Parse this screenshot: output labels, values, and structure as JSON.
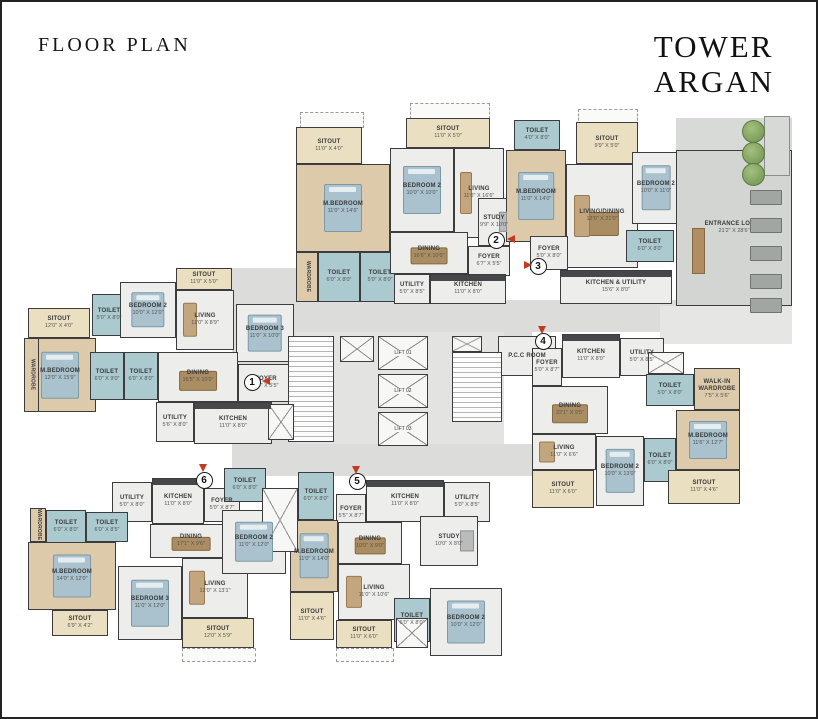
{
  "header": {
    "title": "FLOOR PLAN",
    "tower_line1": "TOWER",
    "tower_line2": "ARGAN"
  },
  "palette": {
    "wood": "#dccaab",
    "floor": "#ededeb",
    "bath": "#aacad0",
    "sitout": "#eadfc1",
    "lobby": "#d3d5d3",
    "corridor": "#dcdddb",
    "wall": "#3c3c3f",
    "marker_red": "#c23a21",
    "tree_green": "#7aa45a",
    "bed_blue": "#a9c2cd",
    "furniture_brown": "#aa8d63"
  },
  "unit_markers": [
    {
      "n": "1",
      "cx": 252,
      "cy": 382,
      "ax": 262,
      "ay": 377,
      "dir": "left"
    },
    {
      "n": "2",
      "cx": 496,
      "cy": 240,
      "ax": 507,
      "ay": 235,
      "dir": "left"
    },
    {
      "n": "3",
      "cx": 538,
      "cy": 266,
      "ax": 524,
      "ay": 261,
      "dir": "right"
    },
    {
      "n": "4",
      "cx": 543,
      "cy": 341,
      "ax": 538,
      "ay": 326,
      "dir": "down"
    },
    {
      "n": "5",
      "cx": 357,
      "cy": 481,
      "ax": 352,
      "ay": 466,
      "dir": "down"
    },
    {
      "n": "6",
      "cx": 204,
      "cy": 480,
      "ax": 199,
      "ay": 464,
      "dir": "down"
    }
  ],
  "rooms": [
    {
      "unit": "2",
      "name": "SITOUT",
      "dims": "11'0\" X 4'0\"",
      "x": 296,
      "y": 127,
      "w": 66,
      "h": 37,
      "t": "sitout"
    },
    {
      "unit": "2",
      "name": "M.BEDROOM",
      "dims": "11'0\" X 14'6\"",
      "x": 296,
      "y": 164,
      "w": 94,
      "h": 88,
      "t": "wood",
      "bed": true
    },
    {
      "unit": "2",
      "name": "WARDROBE",
      "dims": "",
      "x": 296,
      "y": 252,
      "w": 22,
      "h": 50,
      "t": "wood",
      "vert": true
    },
    {
      "unit": "2",
      "name": "TOILET",
      "dims": "6'0\" X 8'0\"",
      "x": 318,
      "y": 252,
      "w": 42,
      "h": 50,
      "t": "bath"
    },
    {
      "unit": "2",
      "name": "TOILET",
      "dims": "5'0\" X 8'0\"",
      "x": 360,
      "y": 252,
      "w": 40,
      "h": 50,
      "t": "bath"
    },
    {
      "unit": "2",
      "name": "BEDROOM 2",
      "dims": "10'0\" X 10'0\"",
      "x": 390,
      "y": 148,
      "w": 64,
      "h": 84,
      "t": "floor",
      "bed": true
    },
    {
      "unit": "2",
      "name": "SITOUT",
      "dims": "11'0\" X 5'0\"",
      "x": 406,
      "y": 118,
      "w": 84,
      "h": 30,
      "t": "sitout"
    },
    {
      "unit": "2",
      "name": "LIVING",
      "dims": "11'0\" X 16'6\"",
      "x": 454,
      "y": 148,
      "w": 50,
      "h": 90,
      "t": "floor",
      "sofa": true
    },
    {
      "unit": "2",
      "name": "STUDY",
      "dims": "9'9\" X 10'0\"",
      "x": 478,
      "y": 198,
      "w": 32,
      "h": 48,
      "t": "floor",
      "desk": true
    },
    {
      "unit": "2",
      "name": "DINING",
      "dims": "16'6\" X 10'0\"",
      "x": 390,
      "y": 232,
      "w": 78,
      "h": 42,
      "t": "floor",
      "table": true
    },
    {
      "unit": "2",
      "name": "FOYER",
      "dims": "6'7\" X 5'5\"",
      "x": 468,
      "y": 246,
      "w": 42,
      "h": 30,
      "t": "floor"
    },
    {
      "unit": "2",
      "name": "UTILITY",
      "dims": "5'0\" X 8'5\"",
      "x": 394,
      "y": 274,
      "w": 36,
      "h": 30,
      "t": "floor"
    },
    {
      "unit": "2",
      "name": "KITCHEN",
      "dims": "11'0\" X 8'0\"",
      "x": 430,
      "y": 274,
      "w": 76,
      "h": 30,
      "t": "floor",
      "counter": true
    },
    {
      "unit": "3",
      "name": "TOILET",
      "dims": "4'0\" X 8'0\"",
      "x": 514,
      "y": 120,
      "w": 46,
      "h": 30,
      "t": "bath"
    },
    {
      "unit": "3",
      "name": "M.BEDROOM",
      "dims": "11'0\" X 14'0\"",
      "x": 506,
      "y": 150,
      "w": 60,
      "h": 92,
      "t": "wood",
      "bed": true
    },
    {
      "unit": "3",
      "name": "SITOUT",
      "dims": "9'9\" X 5'0\"",
      "x": 576,
      "y": 122,
      "w": 62,
      "h": 42,
      "t": "sitout"
    },
    {
      "unit": "3",
      "name": "LIVING/DINING",
      "dims": "12'0\" X 21'0\"",
      "x": 566,
      "y": 164,
      "w": 72,
      "h": 104,
      "t": "floor",
      "sofa": true,
      "table": true
    },
    {
      "unit": "3",
      "name": "BEDROOM 2",
      "dims": "10'0\" X 11'0\"",
      "x": 632,
      "y": 152,
      "w": 48,
      "h": 72,
      "t": "floor",
      "bed": true
    },
    {
      "unit": "3",
      "name": "TOILET",
      "dims": "6'0\" X 8'0\"",
      "x": 626,
      "y": 230,
      "w": 48,
      "h": 32,
      "t": "bath"
    },
    {
      "unit": "3",
      "name": "FOYER",
      "dims": "5'0\" X 8'0\"",
      "x": 530,
      "y": 236,
      "w": 38,
      "h": 34,
      "t": "floor"
    },
    {
      "unit": "3",
      "name": "KITCHEN & UTILITY",
      "dims": "15'6\" X 8'0\"",
      "x": 560,
      "y": 270,
      "w": 112,
      "h": 34,
      "t": "floor",
      "counter": true
    },
    {
      "unit": "",
      "name": "ENTRANCE LOBBY",
      "dims": "21'2\" X 28'6\"",
      "x": 676,
      "y": 150,
      "w": 116,
      "h": 156,
      "t": "lobby"
    },
    {
      "unit": "",
      "name": "P.C.C ROOM",
      "dims": "",
      "x": 498,
      "y": 336,
      "w": 58,
      "h": 40,
      "t": "floor"
    },
    {
      "unit": "1",
      "name": "SITOUT",
      "dims": "12'0\" X 4'0\"",
      "x": 28,
      "y": 308,
      "w": 62,
      "h": 30,
      "t": "sitout"
    },
    {
      "unit": "1",
      "name": "M.BEDROOM",
      "dims": "12'0\" X 15'9\"",
      "x": 24,
      "y": 338,
      "w": 72,
      "h": 74,
      "t": "wood",
      "bed": true
    },
    {
      "unit": "1",
      "name": "WARDROBE",
      "dims": "",
      "x": 24,
      "y": 338,
      "w": 15,
      "h": 74,
      "t": "wood",
      "vert": true
    },
    {
      "unit": "1",
      "name": "TOILET",
      "dims": "5'0\" X 8'0\"",
      "x": 92,
      "y": 294,
      "w": 34,
      "h": 42,
      "t": "bath"
    },
    {
      "unit": "1",
      "name": "BEDROOM 2",
      "dims": "10'0\" X 12'0\"",
      "x": 120,
      "y": 282,
      "w": 56,
      "h": 56,
      "t": "floor",
      "bed": true
    },
    {
      "unit": "1",
      "name": "SITOUT",
      "dims": "11'0\" X 5'0\"",
      "x": 176,
      "y": 268,
      "w": 56,
      "h": 22,
      "t": "sitout"
    },
    {
      "unit": "1",
      "name": "LIVING",
      "dims": "11'0\" X 8'9\"",
      "x": 176,
      "y": 290,
      "w": 58,
      "h": 60,
      "t": "floor",
      "sofa": true
    },
    {
      "unit": "1",
      "name": "BEDROOM 3",
      "dims": "11'0\" X 10'0\"",
      "x": 236,
      "y": 304,
      "w": 58,
      "h": 58,
      "t": "floor",
      "bed": true
    },
    {
      "unit": "1",
      "name": "TOILET",
      "dims": "6'0\" X 9'0\"",
      "x": 90,
      "y": 352,
      "w": 34,
      "h": 48,
      "t": "bath"
    },
    {
      "unit": "1",
      "name": "TOILET",
      "dims": "6'0\" X 8'0\"",
      "x": 124,
      "y": 352,
      "w": 34,
      "h": 48,
      "t": "bath"
    },
    {
      "unit": "1",
      "name": "DINING",
      "dims": "16'5\" X 10'0\"",
      "x": 158,
      "y": 352,
      "w": 80,
      "h": 50,
      "t": "floor",
      "table": true
    },
    {
      "unit": "1",
      "name": "FOYER",
      "dims": "8'6\" X 5'5\"",
      "x": 238,
      "y": 364,
      "w": 56,
      "h": 38,
      "t": "floor"
    },
    {
      "unit": "1",
      "name": "UTILITY",
      "dims": "5'6\" X 8'0\"",
      "x": 156,
      "y": 402,
      "w": 38,
      "h": 40,
      "t": "floor"
    },
    {
      "unit": "1",
      "name": "KITCHEN",
      "dims": "11'0\" X 8'0\"",
      "x": 194,
      "y": 402,
      "w": 78,
      "h": 42,
      "t": "floor",
      "counter": true
    },
    {
      "unit": "4",
      "name": "FOYER",
      "dims": "5'0\" X 8'7\"",
      "x": 532,
      "y": 348,
      "w": 30,
      "h": 38,
      "t": "floor"
    },
    {
      "unit": "4",
      "name": "KITCHEN",
      "dims": "11'0\" X 8'0\"",
      "x": 562,
      "y": 334,
      "w": 58,
      "h": 44,
      "t": "floor",
      "counter": true
    },
    {
      "unit": "4",
      "name": "UTILITY",
      "dims": "5'0\" X 8'5\"",
      "x": 620,
      "y": 338,
      "w": 44,
      "h": 38,
      "t": "floor"
    },
    {
      "unit": "4",
      "name": "DINING",
      "dims": "22'1\" X 9'5\"",
      "x": 532,
      "y": 386,
      "w": 76,
      "h": 48,
      "t": "floor",
      "table": true
    },
    {
      "unit": "4",
      "name": "TOILET",
      "dims": "5'0\" X 8'0\"",
      "x": 646,
      "y": 374,
      "w": 48,
      "h": 32,
      "t": "bath"
    },
    {
      "unit": "4",
      "name": "WALK-IN WARDROBE",
      "dims": "7'5\" X 5'6\"",
      "x": 694,
      "y": 368,
      "w": 46,
      "h": 42,
      "t": "wood"
    },
    {
      "unit": "4",
      "name": "M.BEDROOM",
      "dims": "11'6\" X 12'7\"",
      "x": 676,
      "y": 410,
      "w": 64,
      "h": 60,
      "t": "wood",
      "bed": true
    },
    {
      "unit": "4",
      "name": "LIVING",
      "dims": "11'0\" X 6'6\"",
      "x": 532,
      "y": 434,
      "w": 64,
      "h": 36,
      "t": "floor",
      "sofa": true
    },
    {
      "unit": "4",
      "name": "BEDROOM 2",
      "dims": "10'0\" X 13'0\"",
      "x": 596,
      "y": 436,
      "w": 48,
      "h": 70,
      "t": "floor",
      "bed": true
    },
    {
      "unit": "4",
      "name": "TOILET",
      "dims": "6'0\" X 8'0\"",
      "x": 644,
      "y": 438,
      "w": 32,
      "h": 44,
      "t": "bath"
    },
    {
      "unit": "4",
      "name": "SITOUT",
      "dims": "11'0\" X 6'0\"",
      "x": 532,
      "y": 470,
      "w": 62,
      "h": 38,
      "t": "sitout"
    },
    {
      "unit": "4",
      "name": "SITOUT",
      "dims": "11'0\" X 4'6\"",
      "x": 668,
      "y": 470,
      "w": 72,
      "h": 34,
      "t": "sitout"
    },
    {
      "unit": "6",
      "name": "UTILITY",
      "dims": "5'0\" X 8'0\"",
      "x": 112,
      "y": 482,
      "w": 40,
      "h": 40,
      "t": "floor"
    },
    {
      "unit": "6",
      "name": "KITCHEN",
      "dims": "11'0\" X 8'0\"",
      "x": 152,
      "y": 478,
      "w": 52,
      "h": 46,
      "t": "floor",
      "counter": true
    },
    {
      "unit": "6",
      "name": "FOYER",
      "dims": "5'0\" X 8'7\"",
      "x": 204,
      "y": 488,
      "w": 36,
      "h": 34,
      "t": "floor"
    },
    {
      "unit": "6",
      "name": "TOILET",
      "dims": "6'0\" X 8'0\"",
      "x": 46,
      "y": 510,
      "w": 40,
      "h": 34,
      "t": "bath"
    },
    {
      "unit": "6",
      "name": "TOILET",
      "dims": "6'0\" X 8'5\"",
      "x": 86,
      "y": 512,
      "w": 42,
      "h": 30,
      "t": "bath"
    },
    {
      "unit": "6",
      "name": "M.BEDROOM",
      "dims": "14'0\" X 12'0\"",
      "x": 28,
      "y": 542,
      "w": 88,
      "h": 68,
      "t": "wood",
      "bed": true
    },
    {
      "unit": "6",
      "name": "WARDROBE",
      "dims": "",
      "x": 30,
      "y": 508,
      "w": 16,
      "h": 34,
      "t": "wood",
      "vert": true
    },
    {
      "unit": "6",
      "name": "SITOUT",
      "dims": "6'9\" X 4'2\"",
      "x": 52,
      "y": 610,
      "w": 56,
      "h": 26,
      "t": "sitout"
    },
    {
      "unit": "6",
      "name": "DINING",
      "dims": "17'1\" X 9'6\"",
      "x": 150,
      "y": 524,
      "w": 82,
      "h": 34,
      "t": "floor",
      "table": true
    },
    {
      "unit": "6",
      "name": "BEDROOM 3",
      "dims": "11'0\" X 12'0\"",
      "x": 118,
      "y": 566,
      "w": 64,
      "h": 74,
      "t": "floor",
      "bed": true
    },
    {
      "unit": "6",
      "name": "LIVING",
      "dims": "12'0\" X 13'1\"",
      "x": 182,
      "y": 558,
      "w": 66,
      "h": 60,
      "t": "floor",
      "sofa": true
    },
    {
      "unit": "6",
      "name": "SITOUT",
      "dims": "12'0\" X 5'9\"",
      "x": 182,
      "y": 618,
      "w": 72,
      "h": 30,
      "t": "sitout"
    },
    {
      "unit": "6",
      "name": "TOILET",
      "dims": "6'0\" X 8'0\"",
      "x": 224,
      "y": 468,
      "w": 42,
      "h": 34,
      "t": "bath"
    },
    {
      "unit": "6",
      "name": "BEDROOM 2",
      "dims": "11'0\" X 12'0\"",
      "x": 222,
      "y": 510,
      "w": 64,
      "h": 64,
      "t": "floor",
      "bed": true
    },
    {
      "unit": "5",
      "name": "TOILET",
      "dims": "6'0\" X 8'0\"",
      "x": 298,
      "y": 472,
      "w": 36,
      "h": 48,
      "t": "bath"
    },
    {
      "unit": "5",
      "name": "FOYER",
      "dims": "5'5\" X 8'7\"",
      "x": 336,
      "y": 494,
      "w": 30,
      "h": 38,
      "t": "floor"
    },
    {
      "unit": "5",
      "name": "KITCHEN",
      "dims": "11'0\" X 8'0\"",
      "x": 366,
      "y": 480,
      "w": 78,
      "h": 42,
      "t": "floor",
      "counter": true
    },
    {
      "unit": "5",
      "name": "UTILITY",
      "dims": "5'0\" X 8'5\"",
      "x": 444,
      "y": 482,
      "w": 46,
      "h": 40,
      "t": "floor"
    },
    {
      "unit": "5",
      "name": "M.BEDROOM",
      "dims": "11'0\" X 14'0\"",
      "x": 290,
      "y": 520,
      "w": 48,
      "h": 72,
      "t": "wood",
      "bed": true
    },
    {
      "unit": "5",
      "name": "DINING",
      "dims": "10'0\" X 9'0\"",
      "x": 338,
      "y": 522,
      "w": 64,
      "h": 42,
      "t": "floor",
      "table": true
    },
    {
      "unit": "5",
      "name": "STUDY",
      "dims": "10'0\" X 8'0\"",
      "x": 420,
      "y": 516,
      "w": 58,
      "h": 50,
      "t": "floor",
      "desk": true
    },
    {
      "unit": "5",
      "name": "LIVING",
      "dims": "11'0\" X 10'6\"",
      "x": 338,
      "y": 564,
      "w": 72,
      "h": 56,
      "t": "floor",
      "sofa": true
    },
    {
      "unit": "5",
      "name": "SITOUT",
      "dims": "11'0\" X 4'6\"",
      "x": 290,
      "y": 592,
      "w": 44,
      "h": 48,
      "t": "sitout"
    },
    {
      "unit": "5",
      "name": "SITOUT",
      "dims": "11'0\" X 6'0\"",
      "x": 336,
      "y": 620,
      "w": 56,
      "h": 28,
      "t": "sitout"
    },
    {
      "unit": "5",
      "name": "TOILET",
      "dims": "6'0\" X 8'0\"",
      "x": 394,
      "y": 598,
      "w": 36,
      "h": 44,
      "t": "bath"
    },
    {
      "unit": "5",
      "name": "BEDROOM 2",
      "dims": "10'0\" X 12'0\"",
      "x": 430,
      "y": 588,
      "w": 72,
      "h": 68,
      "t": "floor",
      "bed": true
    }
  ],
  "lifts": [
    {
      "label": "LIFT 01",
      "x": 378,
      "y": 336,
      "w": 50,
      "h": 34
    },
    {
      "label": "LIFT 02",
      "x": 378,
      "y": 374,
      "w": 50,
      "h": 34
    },
    {
      "label": "LIFT 03",
      "x": 378,
      "y": 412,
      "w": 50,
      "h": 34
    }
  ],
  "stairs": [
    {
      "x": 288,
      "y": 336,
      "w": 46,
      "h": 106
    },
    {
      "x": 452,
      "y": 352,
      "w": 50,
      "h": 70
    }
  ],
  "shafts": [
    {
      "x": 340,
      "y": 336,
      "w": 34,
      "h": 26
    },
    {
      "x": 452,
      "y": 336,
      "w": 30,
      "h": 16
    },
    {
      "x": 262,
      "y": 488,
      "w": 36,
      "h": 64
    },
    {
      "x": 396,
      "y": 618,
      "w": 32,
      "h": 30
    },
    {
      "x": 648,
      "y": 352,
      "w": 36,
      "h": 22
    },
    {
      "x": 268,
      "y": 404,
      "w": 26,
      "h": 36
    }
  ],
  "corridors": [
    {
      "x": 232,
      "y": 300,
      "w": 448,
      "h": 32
    },
    {
      "x": 232,
      "y": 268,
      "w": 64,
      "h": 178
    },
    {
      "x": 232,
      "y": 444,
      "w": 300,
      "h": 32
    },
    {
      "x": 504,
      "y": 300,
      "w": 28,
      "h": 66
    },
    {
      "x": 296,
      "y": 332,
      "w": 208,
      "h": 112,
      "color": "#e3e4e2"
    },
    {
      "x": 660,
      "y": 306,
      "w": 132,
      "h": 38,
      "color": "#e6e7e5"
    },
    {
      "x": 676,
      "y": 118,
      "w": 116,
      "h": 34,
      "color": "#d8dad8"
    }
  ],
  "dashed": [
    {
      "x": 300,
      "y": 112,
      "w": 62,
      "h": 14
    },
    {
      "x": 410,
      "y": 103,
      "w": 78,
      "h": 14
    },
    {
      "x": 578,
      "y": 109,
      "w": 58,
      "h": 14
    },
    {
      "x": 182,
      "y": 648,
      "w": 72,
      "h": 12
    },
    {
      "x": 336,
      "y": 648,
      "w": 56,
      "h": 12
    }
  ],
  "lobby": {
    "benches": [
      {
        "x": 750,
        "y": 190
      },
      {
        "x": 750,
        "y": 218
      },
      {
        "x": 750,
        "y": 246
      },
      {
        "x": 750,
        "y": 274
      },
      {
        "x": 750,
        "y": 298
      }
    ],
    "bench_w": 30,
    "bench_h": 13,
    "desk": {
      "x": 692,
      "y": 228,
      "w": 11,
      "h": 44
    },
    "trees": [
      {
        "x": 742,
        "y": 120
      },
      {
        "x": 742,
        "y": 142
      },
      {
        "x": 742,
        "y": 163
      }
    ],
    "tree_d": 21,
    "planter": {
      "x": 764,
      "y": 116,
      "w": 26,
      "h": 60
    }
  }
}
